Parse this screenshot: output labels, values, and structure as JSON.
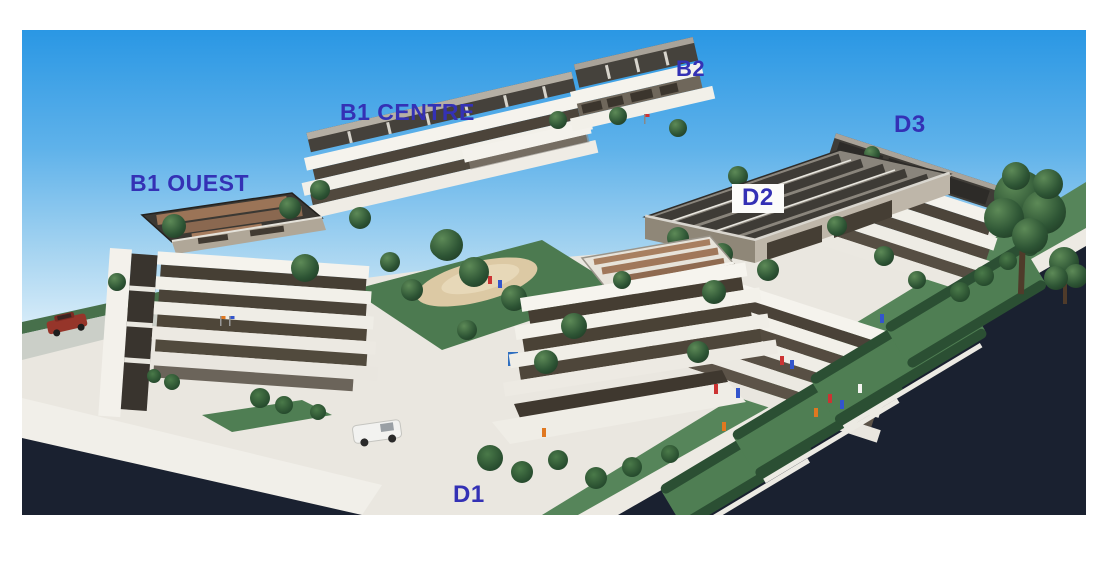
{
  "labels": {
    "b1_ouest": "B1 OUEST",
    "b1_centre": "B1 CENTRE",
    "b2": "B2",
    "d2": "D2",
    "d3": "D3",
    "d1": "D1"
  },
  "colors": {
    "label_blue": "#3431b5",
    "sky_top": "#2a97e4",
    "sky_horizon": "#e2f1fa",
    "surround_dark_navy": "#1a2130",
    "platform_light": "#eae7e0",
    "facade_white": "#f5f3ed",
    "window_band_dark": "#4a4238",
    "roof_charcoal": "#3b3833",
    "roof_tan_panels": "#9b7457",
    "solar_roof_grey": "#8a857c",
    "lawn_green": "#4f7e53",
    "hedge_green": "#2b4f33",
    "red_car": "#96352a",
    "white_car": "#f2f2f0"
  }
}
